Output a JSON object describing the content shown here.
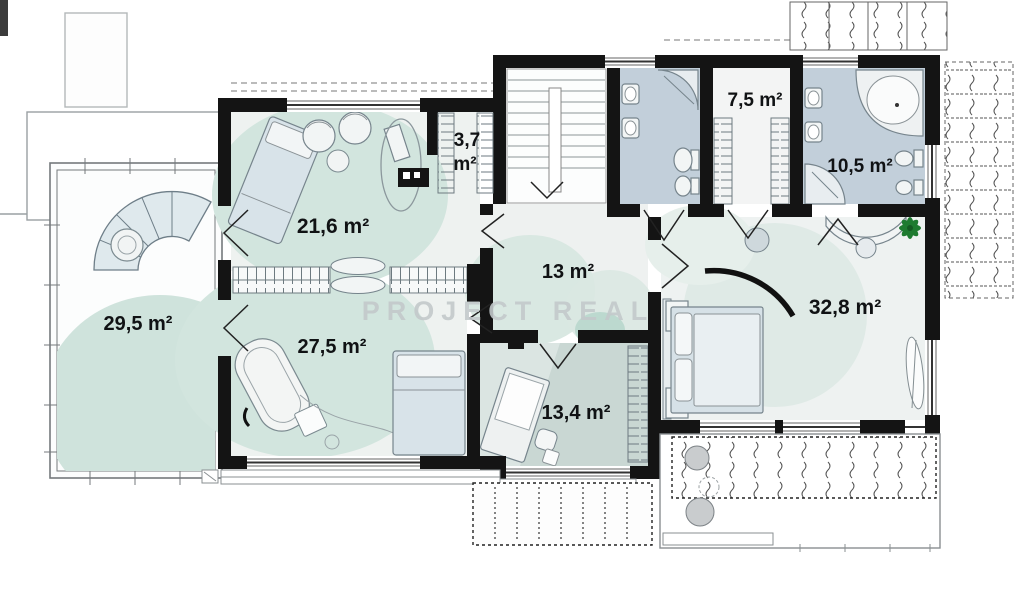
{
  "watermark": {
    "text": "PROJECT REAL"
  },
  "rooms": [
    {
      "id": "terrace",
      "label": "29,5 m²"
    },
    {
      "id": "bedroom-1",
      "label": "21,6 m²"
    },
    {
      "id": "closet",
      "label": "3,7 m²",
      "lines": [
        "3,7",
        "m²"
      ]
    },
    {
      "id": "wardrobe",
      "label": "7,5 m²"
    },
    {
      "id": "bathroom-large",
      "label": "10,5 m²"
    },
    {
      "id": "hall",
      "label": "13 m²"
    },
    {
      "id": "master-bedroom",
      "label": "32,8 m²"
    },
    {
      "id": "bedroom-2",
      "label": "27,5 m²"
    },
    {
      "id": "study",
      "label": "13,4 m²"
    }
  ],
  "colors": {
    "wall": "#141414",
    "mint_floor": "#d2e5de",
    "bath_floor": "#c2cfda",
    "study_floor": "#c9d7d3",
    "furniture_stroke": "#76848c",
    "watermark": "#c3c9cb",
    "plant_green": "#1e7b30"
  }
}
